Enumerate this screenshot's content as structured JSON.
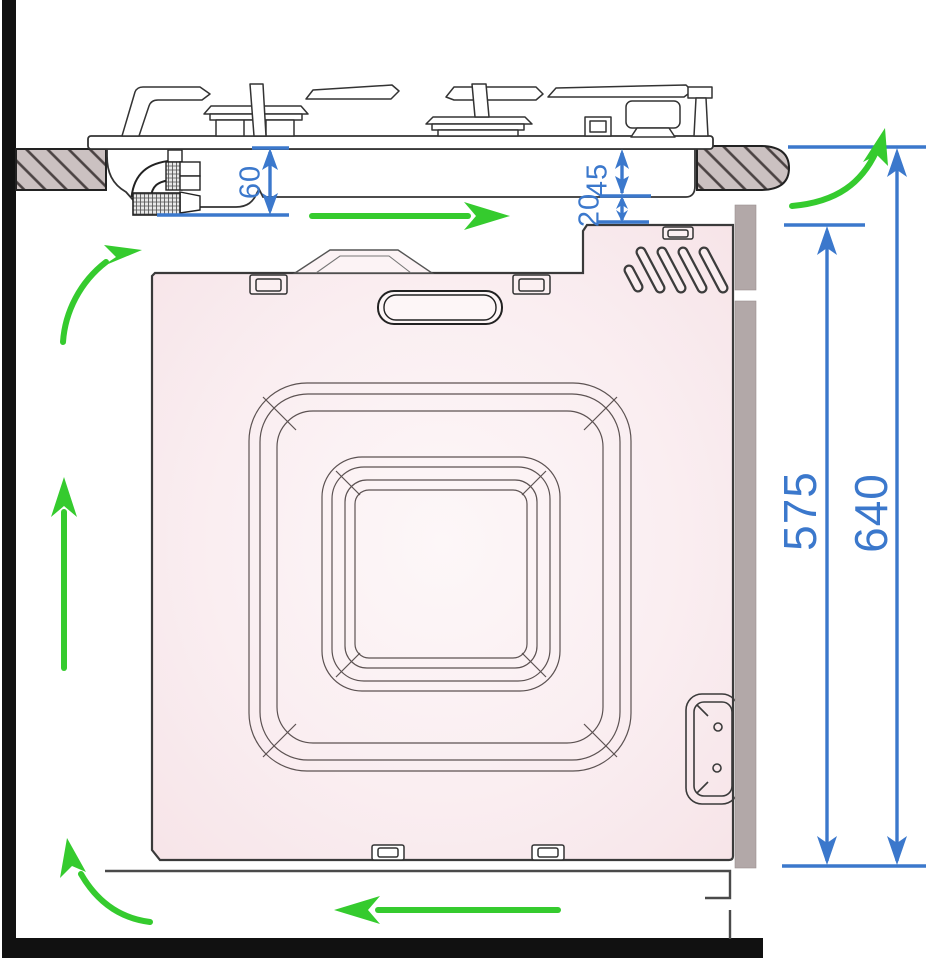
{
  "diagram": {
    "kind": "appliance-installation-section-drawing",
    "dimensions": {
      "d60": "60",
      "d45": "45",
      "d20": "20",
      "d575": "575",
      "d640": "640"
    },
    "icons": [
      {
        "name": "airflow-arrow-under-hob",
        "direction": "right"
      },
      {
        "name": "airflow-arrow-top-right",
        "direction": "up-curved"
      },
      {
        "name": "airflow-arrow-mid-left",
        "direction": "up-right-curved"
      },
      {
        "name": "airflow-arrow-left-vertical",
        "direction": "up"
      },
      {
        "name": "airflow-arrow-bottom-left",
        "direction": "up-curved"
      },
      {
        "name": "airflow-arrow-bottom",
        "direction": "left"
      }
    ],
    "colors": {
      "dimension_blue": "#3b78cc",
      "airflow_green": "#35cb2e",
      "oven_pink": "#f8e7ea",
      "worktop_gray": "#cbc1c1",
      "panel_gray": "#b2a8a8",
      "frame_black": "#111111",
      "line_dark": "#3a3a3a"
    }
  }
}
